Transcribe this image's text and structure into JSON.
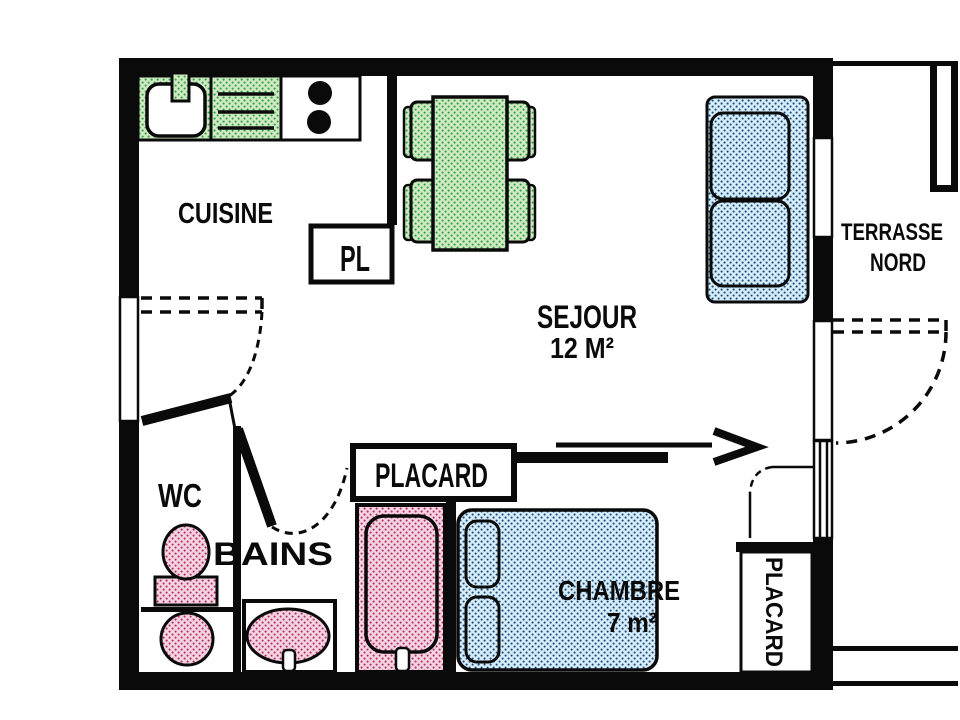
{
  "labels": {
    "cuisine": "CUISINE",
    "pl": "PL",
    "sejour_line1": "SEJOUR",
    "sejour_line2": "12 M²",
    "terrasse_line1": "TERRASSE",
    "terrasse_line2": "NORD",
    "wc": "WC",
    "bains": "BAINS",
    "placard_sejour": "PLACARD",
    "chambre_line1": "CHAMBRE",
    "chambre_line2": "7 m²",
    "placard_chambre": "PLACARD"
  },
  "colors": {
    "wall": "#0a0a0a",
    "background": "#ffffff",
    "kitchen_fixture_fill": "#cfeac2",
    "kitchen_fixture_dot": "#2f9e44",
    "bed_sofa_fill": "#d6ecf8",
    "bed_sofa_dot": "#1a4a7a",
    "bath_fixture_fill": "#f5d3e3",
    "bath_fixture_dot": "#b03060",
    "line": "#0a0a0a"
  }
}
